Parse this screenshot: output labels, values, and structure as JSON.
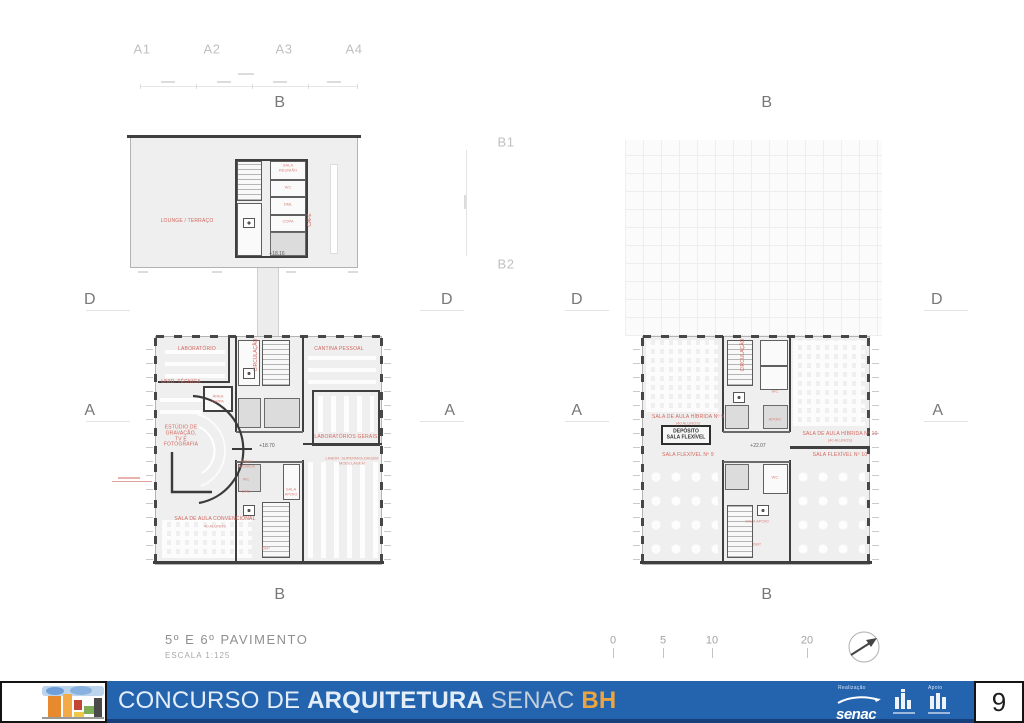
{
  "page_number": "9",
  "colors": {
    "banner_blue": "#2463ae",
    "accent_orange": "#eca43e",
    "plan_label_red": "#d4675e"
  },
  "title_block": {
    "title": "5º E 6º PAVIMENTO",
    "scale": "ESCALA 1:125"
  },
  "footer": {
    "title1": "CONCURSO DE ",
    "title_bold": "ARQUITETURA",
    "title_senac": " SENAC ",
    "title_bh": "BH",
    "realizacao_label": "Realização",
    "apoio_label": "Apoio",
    "senac_wordmark": "senac"
  },
  "labels": [
    {
      "t": "A1",
      "x": 142,
      "y": 50,
      "c": "gl"
    },
    {
      "t": "A2",
      "x": 212,
      "y": 50,
      "c": "gl"
    },
    {
      "t": "A3",
      "x": 284,
      "y": 50,
      "c": "gl"
    },
    {
      "t": "A4",
      "x": 354,
      "y": 50,
      "c": "gl"
    },
    {
      "t": "B",
      "x": 280,
      "y": 103,
      "c": "g"
    },
    {
      "t": "B",
      "x": 767,
      "y": 103,
      "c": "g"
    },
    {
      "t": "B1",
      "x": 506,
      "y": 143,
      "c": "gl"
    },
    {
      "t": "B2",
      "x": 506,
      "y": 265,
      "c": "gl"
    },
    {
      "t": "D",
      "x": 90,
      "y": 300,
      "c": "g"
    },
    {
      "t": "D",
      "x": 447,
      "y": 300,
      "c": "g"
    },
    {
      "t": "D",
      "x": 577,
      "y": 300,
      "c": "g"
    },
    {
      "t": "D",
      "x": 937,
      "y": 300,
      "c": "g"
    },
    {
      "t": "A",
      "x": 90,
      "y": 411,
      "c": "g"
    },
    {
      "t": "A",
      "x": 450,
      "y": 411,
      "c": "g"
    },
    {
      "t": "A",
      "x": 577,
      "y": 411,
      "c": "g"
    },
    {
      "t": "A",
      "x": 938,
      "y": 411,
      "c": "g"
    },
    {
      "t": "B",
      "x": 280,
      "y": 595,
      "c": "g"
    },
    {
      "t": "B",
      "x": 767,
      "y": 595,
      "c": "g"
    },
    {
      "t": "LOUNGE / TERRAÇO",
      "x": 187,
      "y": 222,
      "c": "r"
    },
    {
      "t": "CAFÉ",
      "x": 311,
      "y": 220,
      "c": "rv"
    },
    {
      "t": "SALA\nREUNIÃO",
      "x": 288,
      "y": 168,
      "c": "r4"
    },
    {
      "t": "WC",
      "x": 288,
      "y": 188,
      "c": "r4"
    },
    {
      "t": "DML",
      "x": 288,
      "y": 205,
      "c": "r4"
    },
    {
      "t": "COPA",
      "x": 288,
      "y": 222,
      "c": "r4"
    },
    {
      "t": "+18.16",
      "x": 277,
      "y": 255,
      "c": "e"
    },
    {
      "t": "LABORATÓRIO",
      "x": 197,
      "y": 350,
      "c": "r"
    },
    {
      "t": "CANTINA PESSOAL",
      "x": 339,
      "y": 350,
      "c": "r"
    },
    {
      "t": "UNID. TÉCNICA",
      "x": 181,
      "y": 383,
      "c": "r"
    },
    {
      "t": "ÁREA\nLIMPA",
      "x": 218,
      "y": 399,
      "c": "r4"
    },
    {
      "t": "ESTÚDIO DE\nGRAVAÇÃO,\nTV E\nFOTOGRAFIA",
      "x": 181,
      "y": 437,
      "c": "r",
      "w": 46
    },
    {
      "t": "LABORATÓRIOS GERAIS",
      "x": 346,
      "y": 438,
      "c": "r"
    },
    {
      "t": "LABOR. SUPERMOLDAGEM\nMODELAGEM",
      "x": 352,
      "y": 461,
      "c": "r4",
      "w": 62
    },
    {
      "t": "SALA DE AULA CONVENCIONAL",
      "x": 215,
      "y": 520,
      "c": "r"
    },
    {
      "t": "40 ALUNOS",
      "x": 215,
      "y": 527,
      "c": "r4"
    },
    {
      "t": "CIRCULAÇÃO",
      "x": 257,
      "y": 355,
      "c": "rv"
    },
    {
      "t": "+18.70",
      "x": 267,
      "y": 447,
      "c": "e"
    },
    {
      "t": "ÁREA\nTÉCNICA",
      "x": 246,
      "y": 464,
      "c": "r4"
    },
    {
      "t": "WC",
      "x": 246,
      "y": 480,
      "c": "r4"
    },
    {
      "t": "DML",
      "x": 246,
      "y": 492,
      "c": "r4"
    },
    {
      "t": "SALA\nAPOIO",
      "x": 291,
      "y": 492,
      "c": "r4"
    },
    {
      "t": "DEP.",
      "x": 266,
      "y": 549,
      "c": "r4"
    },
    {
      "t": "SALA DE AULA HÍBRIDA Nº 9",
      "x": 688,
      "y": 418,
      "c": "r"
    },
    {
      "t": "(40 ALUNOS)",
      "x": 688,
      "y": 424,
      "c": "r4"
    },
    {
      "t": "DEPÓSITO\nSALA FLEXÍVEL",
      "x": 686,
      "y": 435,
      "c": "d"
    },
    {
      "t": "SALA FLEXÍVEL Nº 9",
      "x": 688,
      "y": 456,
      "c": "r"
    },
    {
      "t": "SALA DE AULA HÍBRIDA Nº 10",
      "x": 840,
      "y": 435,
      "c": "r"
    },
    {
      "t": "(40 ALUNOS)",
      "x": 840,
      "y": 441,
      "c": "r4"
    },
    {
      "t": "SALA FLEXÍVEL Nº 10",
      "x": 840,
      "y": 456,
      "c": "r"
    },
    {
      "t": "+22.07",
      "x": 758,
      "y": 447,
      "c": "e"
    },
    {
      "t": "CIRCULAÇÃO",
      "x": 744,
      "y": 355,
      "c": "rv"
    },
    {
      "t": "WC",
      "x": 775,
      "y": 392,
      "c": "r4"
    },
    {
      "t": "APOIO",
      "x": 775,
      "y": 420,
      "c": "r4"
    },
    {
      "t": "WC",
      "x": 775,
      "y": 478,
      "c": "r4"
    },
    {
      "t": "SALA APOIO",
      "x": 757,
      "y": 522,
      "c": "r4"
    },
    {
      "t": "DEP.",
      "x": 757,
      "y": 545,
      "c": "r4"
    },
    {
      "t": "0",
      "x": 613,
      "y": 641,
      "c": "st"
    },
    {
      "t": "5",
      "x": 663,
      "y": 641,
      "c": "st"
    },
    {
      "t": "10",
      "x": 712,
      "y": 641,
      "c": "st"
    },
    {
      "t": "20",
      "x": 807,
      "y": 641,
      "c": "st"
    }
  ]
}
